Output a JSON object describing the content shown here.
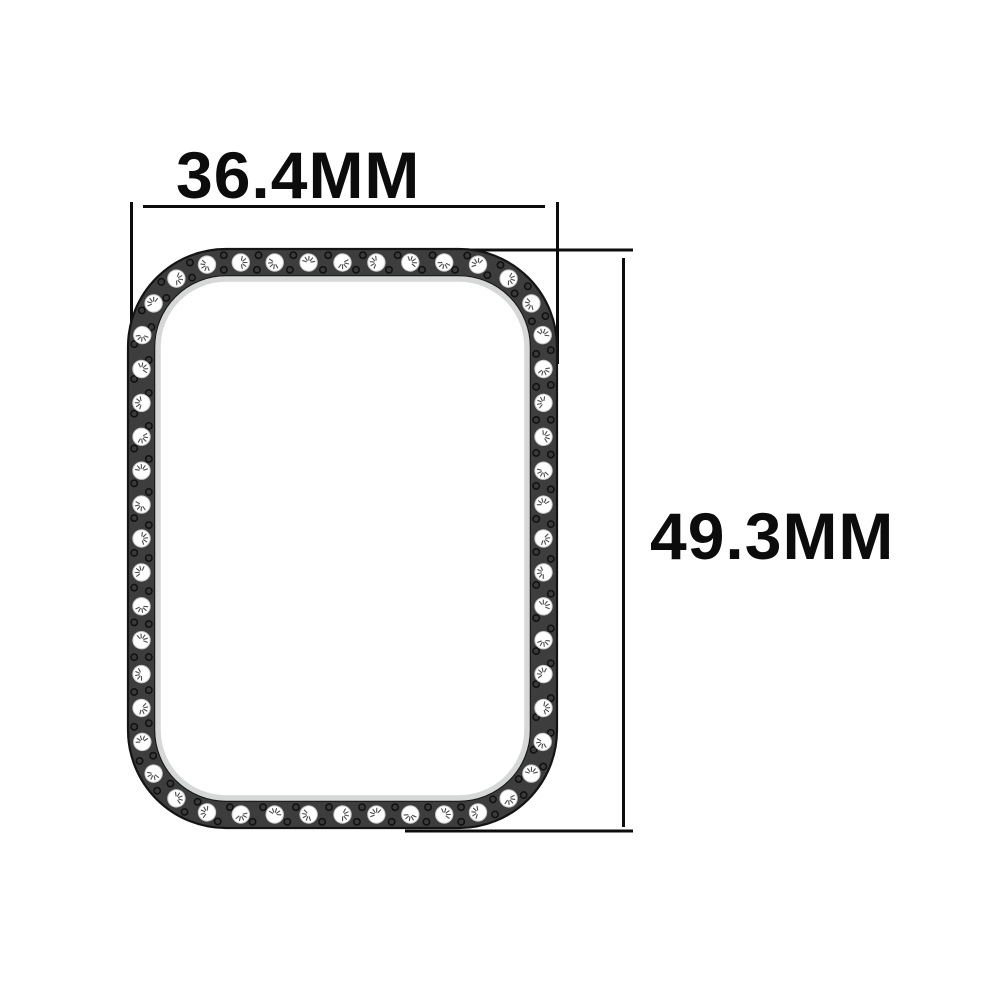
{
  "diagram": {
    "background": "#ffffff",
    "width_dimension": {
      "label": "36.4MM",
      "value_mm": 36.4,
      "unit": "MM",
      "orientation": "horizontal",
      "position": "top"
    },
    "height_dimension": {
      "label": "49.3MM",
      "value_mm": 49.3,
      "unit": "MM",
      "orientation": "vertical",
      "position": "right"
    },
    "annotation_color": "#0d0d0d",
    "ring": {
      "gem_count": 52,
      "colors": {
        "band": "#3d3d3d",
        "band_edge": "#141414",
        "gem": "#ffffff",
        "gem_edge": "#c9c9c9",
        "gem_facet": "#4d4d4d",
        "inner_lip": "#d6d8d8",
        "stud_dot": "#3a3a3a",
        "stud_dot_edge": "#101010"
      }
    }
  }
}
